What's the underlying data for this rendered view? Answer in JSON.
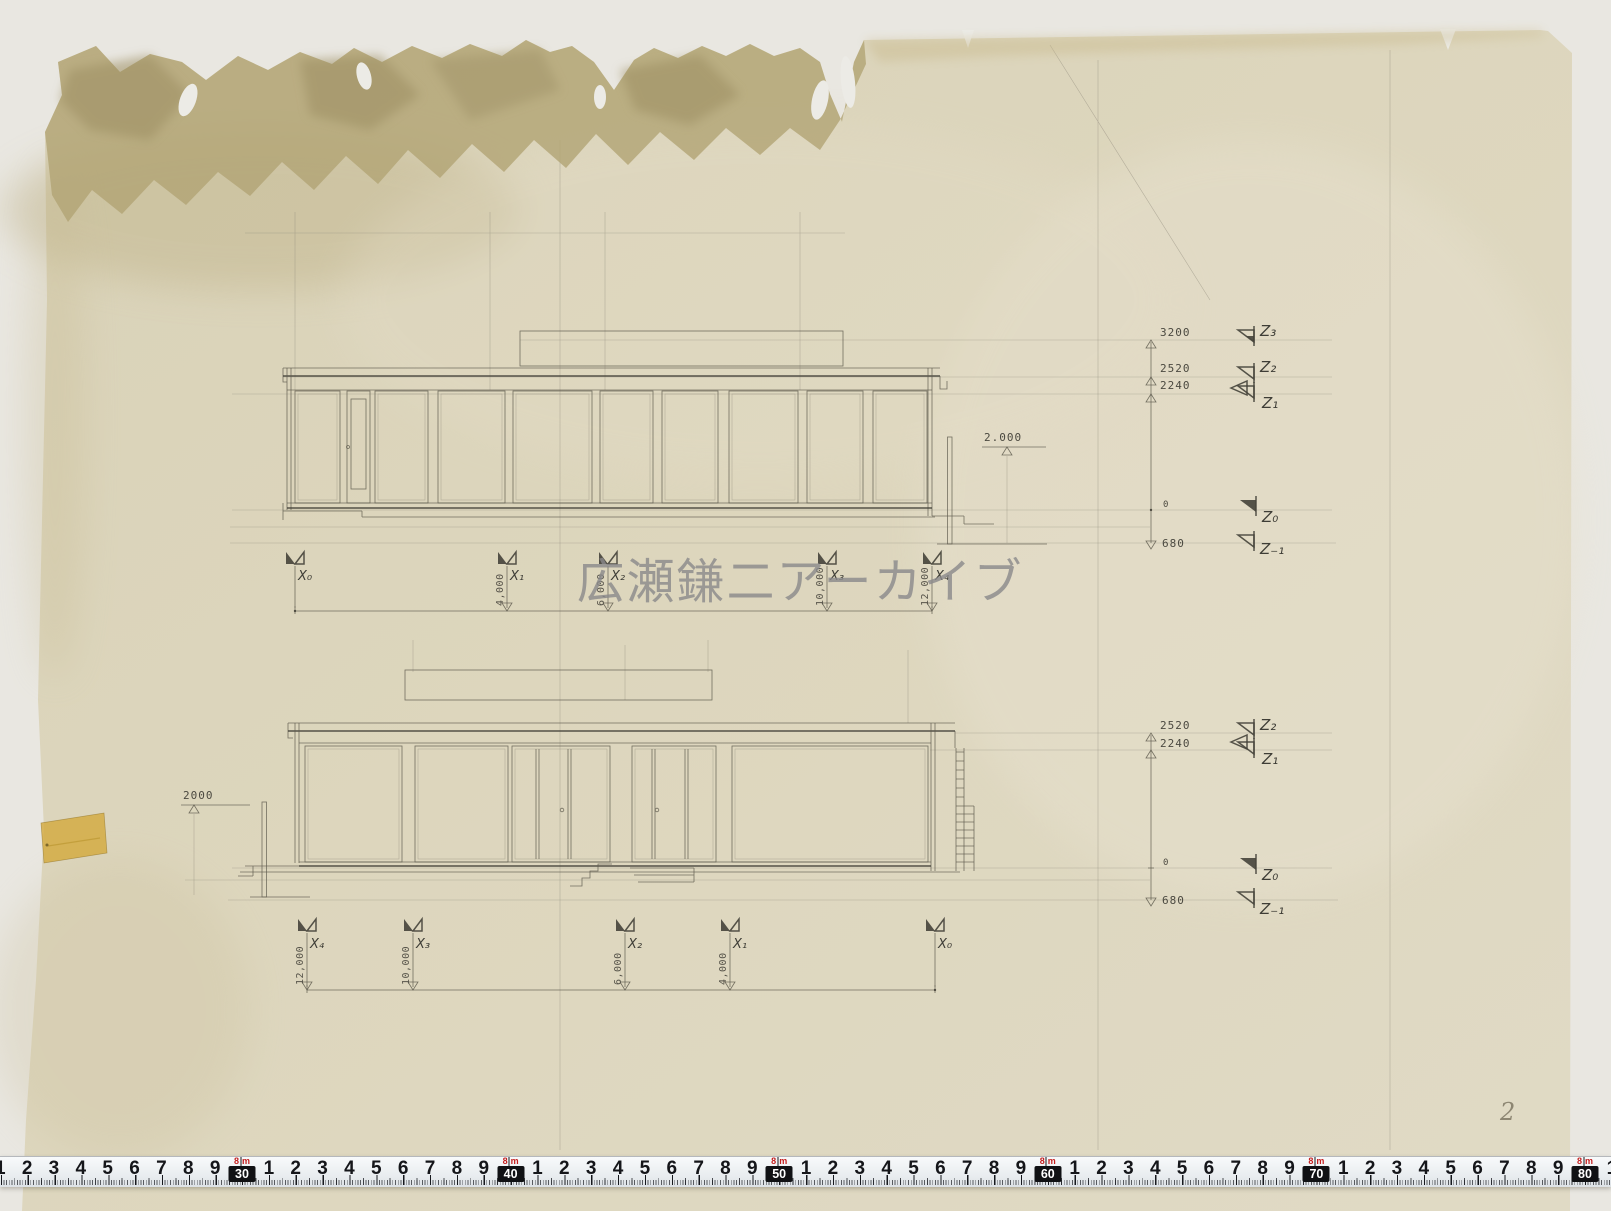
{
  "watermark": "広瀬鎌二アーカイブ",
  "page_number": "2",
  "upper_elevation": {
    "levels": {
      "h3200": "3200",
      "h2520": "2520",
      "h2240": "2240",
      "zero": "0",
      "d680": "680"
    },
    "z_marks": {
      "z3": "Z₃",
      "z2": "Z₂",
      "z1": "Z₁",
      "z0": "Z₀",
      "zm1": "Z₋₁"
    },
    "wall_height": "2.000",
    "grid_marks": {
      "x0": "X₀",
      "x1": "X₁",
      "x2": "X₂",
      "x3": "X₃",
      "x4": "X₄"
    },
    "grid_dims": {
      "x1": "4,000",
      "x2": "6,000",
      "x3": "10,000",
      "x4": "12,000"
    }
  },
  "lower_elevation": {
    "levels": {
      "h2520": "2520",
      "h2240": "2240",
      "zero": "0",
      "d680": "680"
    },
    "z_marks": {
      "z2": "Z₂",
      "z1": "Z₁",
      "z0": "Z₀",
      "zm1": "Z₋₁"
    },
    "wall_height": "2000",
    "grid_marks": {
      "x4": "X₄",
      "x3": "X₃",
      "x2": "X₂",
      "x1": "X₁",
      "x0": "X₀"
    },
    "grid_dims": {
      "x4": "12,000",
      "x3": "10,000",
      "x2": "6,000",
      "x1": "4,000"
    }
  },
  "ruler": {
    "digits": [
      "1",
      "2",
      "3",
      "4",
      "5",
      "6",
      "7",
      "8",
      "9"
    ],
    "decades": [
      "30",
      "40",
      "50",
      "60",
      "70",
      "80"
    ],
    "meter_mark": {
      "value": "8",
      "unit": "m"
    }
  }
}
